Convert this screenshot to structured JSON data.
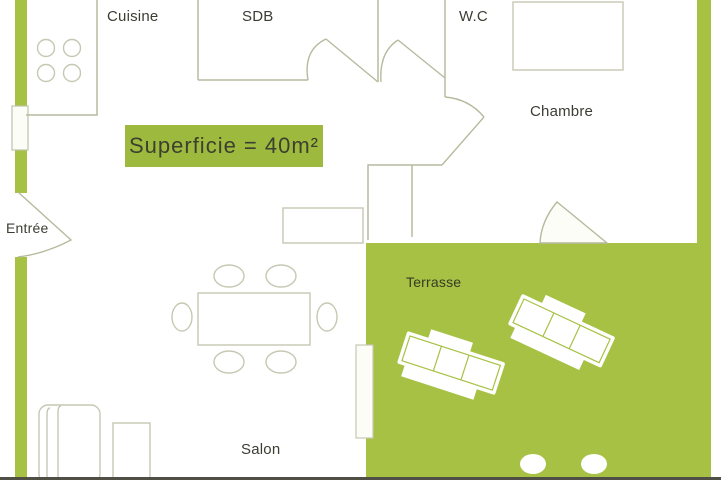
{
  "plan": {
    "area_badge": "Superficie = 40m²",
    "rooms": {
      "kitchen": {
        "label": "Cuisine"
      },
      "bathroom": {
        "label": "SDB"
      },
      "toilet": {
        "label": "W.C"
      },
      "bedroom": {
        "label": "Chambre"
      },
      "entrance": {
        "label": "Entrée"
      },
      "living": {
        "label": "Salon"
      },
      "terrace": {
        "label": "Terrasse"
      }
    },
    "furniture": [
      "stove-icon",
      "dining-table-icon",
      "dining-chair-icon",
      "sofa-icon",
      "side-table-icon",
      "sun-lounger-icon",
      "bed-icon",
      "sideboard-icon",
      "door-swing-icon",
      "window-icon"
    ]
  },
  "colors": {
    "accent_green": "#a6c144",
    "badge_green": "#9eba3e",
    "wall_line": "#b7ba9d",
    "furniture_line": "#c6c8b2",
    "text_dark": "#3c3d33",
    "white": "#fdfdf7",
    "bottom_bar": "#4f4f46"
  }
}
